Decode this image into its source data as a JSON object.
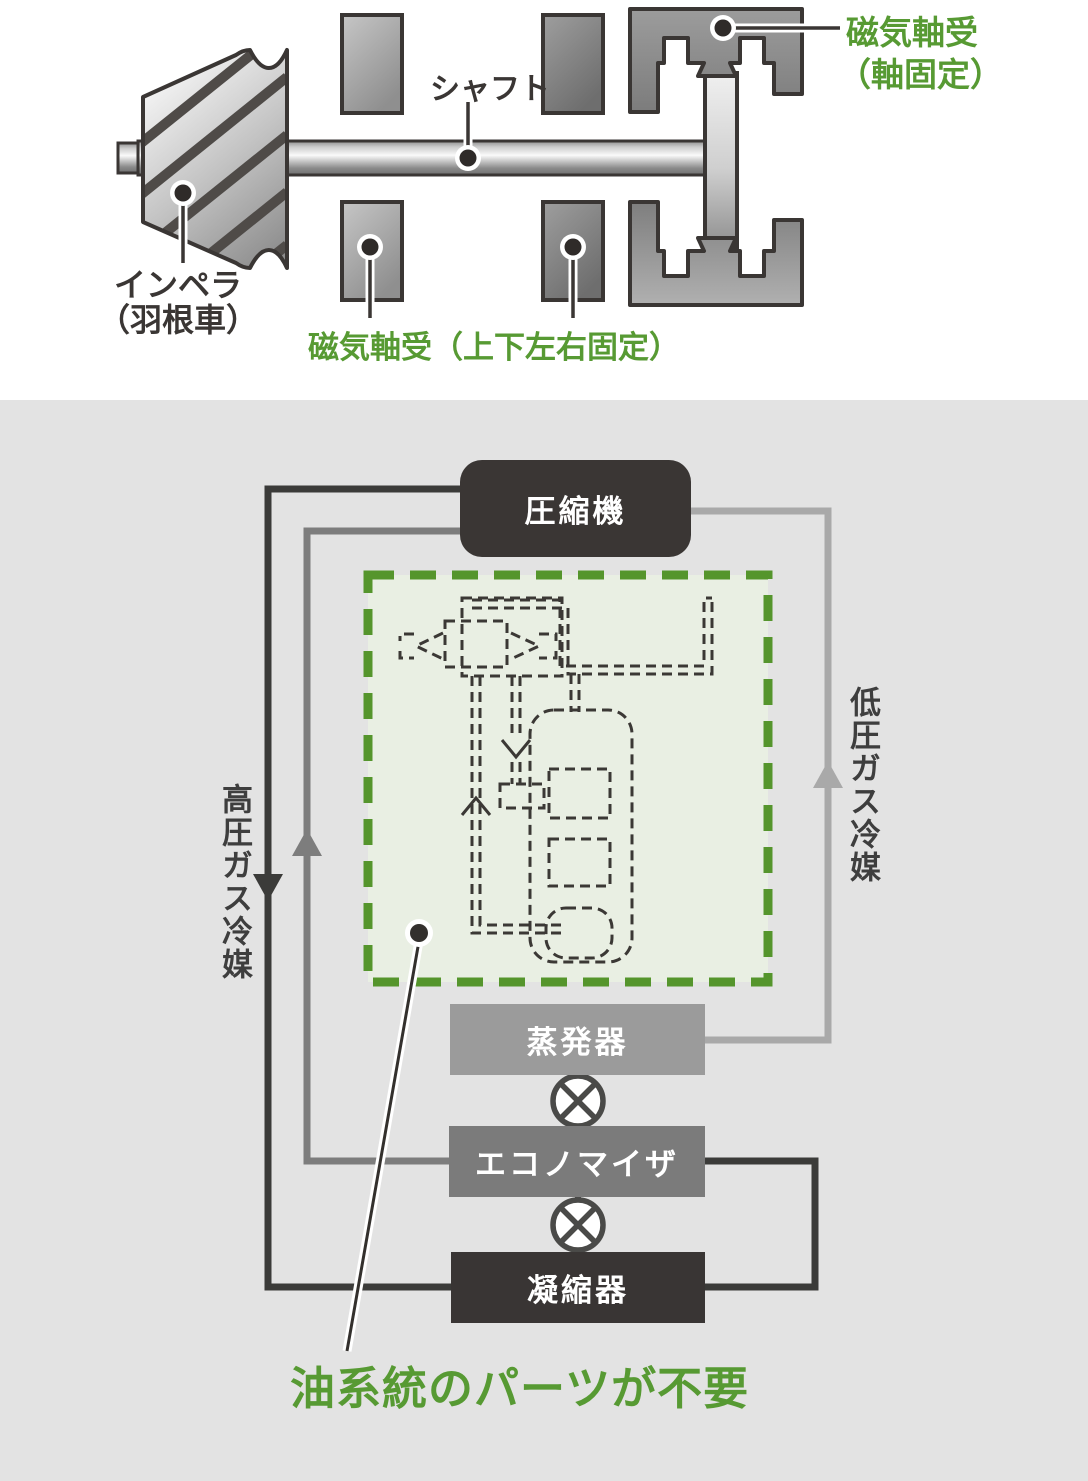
{
  "colors": {
    "accent_green": "#579a33",
    "panel_bg": "#e3e3e3",
    "outline_dark": "#3a3634",
    "line_high_pressure": "#3b3b39",
    "line_economizer_gas": "#7d7d7d",
    "line_low_pressure": "#a9a9a9"
  },
  "top_diagram": {
    "shaft_label": "シャフト",
    "impeller_label_line1": "インペラ",
    "impeller_label_line2": "（羽根車）",
    "radial_bearing_label": "磁気軸受（上下左右固定）",
    "axial_bearing_label_line1": "磁気軸受",
    "axial_bearing_label_line2": "（軸固定）"
  },
  "flow_diagram": {
    "nodes": {
      "compressor": "圧縮機",
      "evaporator": "蒸発器",
      "economizer": "エコノマイザ",
      "condenser": "凝縮器"
    },
    "high_pressure_label": "高圧ガス冷媒",
    "low_pressure_label": "低圧ガス冷媒",
    "callout_label": "油系統のパーツが不要"
  }
}
